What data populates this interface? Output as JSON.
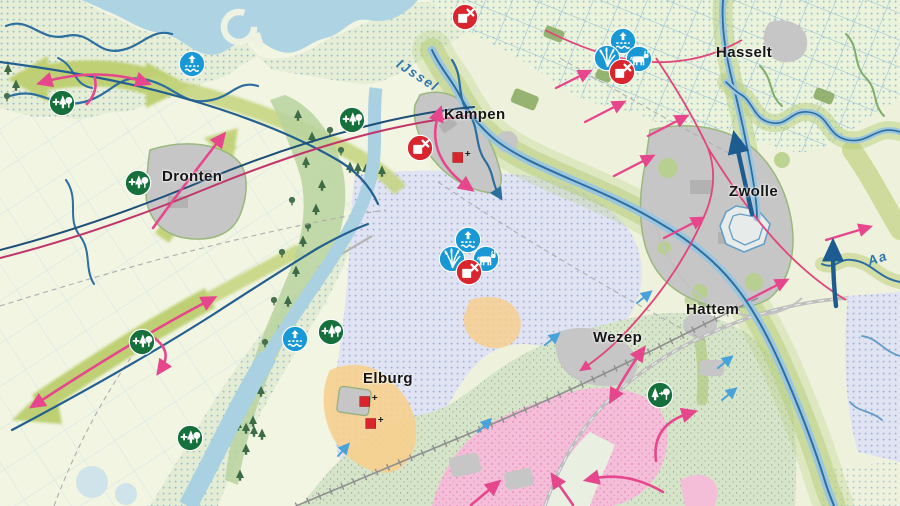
{
  "map": {
    "region_description": "IJssel delta planning map",
    "palette": {
      "water": "#aed4e3",
      "river_line": "#2c6e9e",
      "canal_line": "#23608f",
      "band_green": "#c3d37c",
      "icon_blue": "#1899d6",
      "icon_red": "#d9262e",
      "icon_green": "#15703c",
      "arrow_pink": "#e6468c",
      "arrow_dark_blue": "#1d5c90",
      "arrow_light_blue": "#4aa3d8",
      "heath_pink": "#f4bed9",
      "seepage_lavender": "#e0e3f2",
      "sand_orange": "#f6cf8e",
      "town_gray": "#c6c6c6"
    }
  },
  "town_labels": [
    {
      "id": "dronten",
      "text": "Dronten",
      "x": 162,
      "y": 168
    },
    {
      "id": "kampen",
      "text": "Kampen",
      "x": 444,
      "y": 106
    },
    {
      "id": "hasselt",
      "text": "Hasselt",
      "x": 716,
      "y": 44
    },
    {
      "id": "zwolle",
      "text": "Zwolle",
      "x": 729,
      "y": 183
    },
    {
      "id": "hattem",
      "text": "Hattem",
      "x": 686,
      "y": 301
    },
    {
      "id": "wezep",
      "text": "Wezep",
      "x": 593,
      "y": 329
    },
    {
      "id": "elburg",
      "text": "Elburg",
      "x": 363,
      "y": 370
    }
  ],
  "water_labels": [
    {
      "id": "ijssel",
      "text": "IJssel",
      "x": 398,
      "y": 55,
      "rotate": 33
    },
    {
      "id": "aa",
      "text": "Aa",
      "x": 868,
      "y": 254,
      "rotate": -18
    }
  ],
  "icon_semantics": {
    "water-rise": "water-level-rise-icon",
    "reeds": "reed-marsh-icon",
    "cattle": "cattle-grazing-icon",
    "no-build": "no-construction-icon",
    "new-forest": "new-forest-icon",
    "forest-convert": "forest-conversion-icon"
  },
  "icons": [
    {
      "type": "water-rise",
      "x": 192,
      "y": 64
    },
    {
      "type": "new-forest",
      "x": 62,
      "y": 103
    },
    {
      "type": "new-forest",
      "x": 138,
      "y": 183
    },
    {
      "type": "new-forest",
      "x": 352,
      "y": 120
    },
    {
      "type": "water-rise",
      "x": 295,
      "y": 339
    },
    {
      "type": "new-forest",
      "x": 331,
      "y": 332
    },
    {
      "type": "new-forest",
      "x": 142,
      "y": 342
    },
    {
      "type": "new-forest",
      "x": 190,
      "y": 438
    },
    {
      "type": "no-build",
      "x": 465,
      "y": 17
    },
    {
      "type": "no-build",
      "x": 420,
      "y": 148
    },
    {
      "type": "water-rise",
      "x": 468,
      "y": 240
    },
    {
      "type": "reeds",
      "x": 452,
      "y": 259
    },
    {
      "type": "cattle",
      "x": 486,
      "y": 259
    },
    {
      "type": "no-build",
      "x": 469,
      "y": 272
    },
    {
      "type": "water-rise",
      "x": 623,
      "y": 41
    },
    {
      "type": "reeds",
      "x": 607,
      "y": 58
    },
    {
      "type": "cattle",
      "x": 639,
      "y": 59
    },
    {
      "type": "no-build",
      "x": 622,
      "y": 72
    },
    {
      "type": "forest-convert",
      "x": 660,
      "y": 395
    }
  ],
  "monuments": [
    {
      "x": 458,
      "y": 156
    },
    {
      "x": 365,
      "y": 400
    },
    {
      "x": 371,
      "y": 422
    }
  ]
}
